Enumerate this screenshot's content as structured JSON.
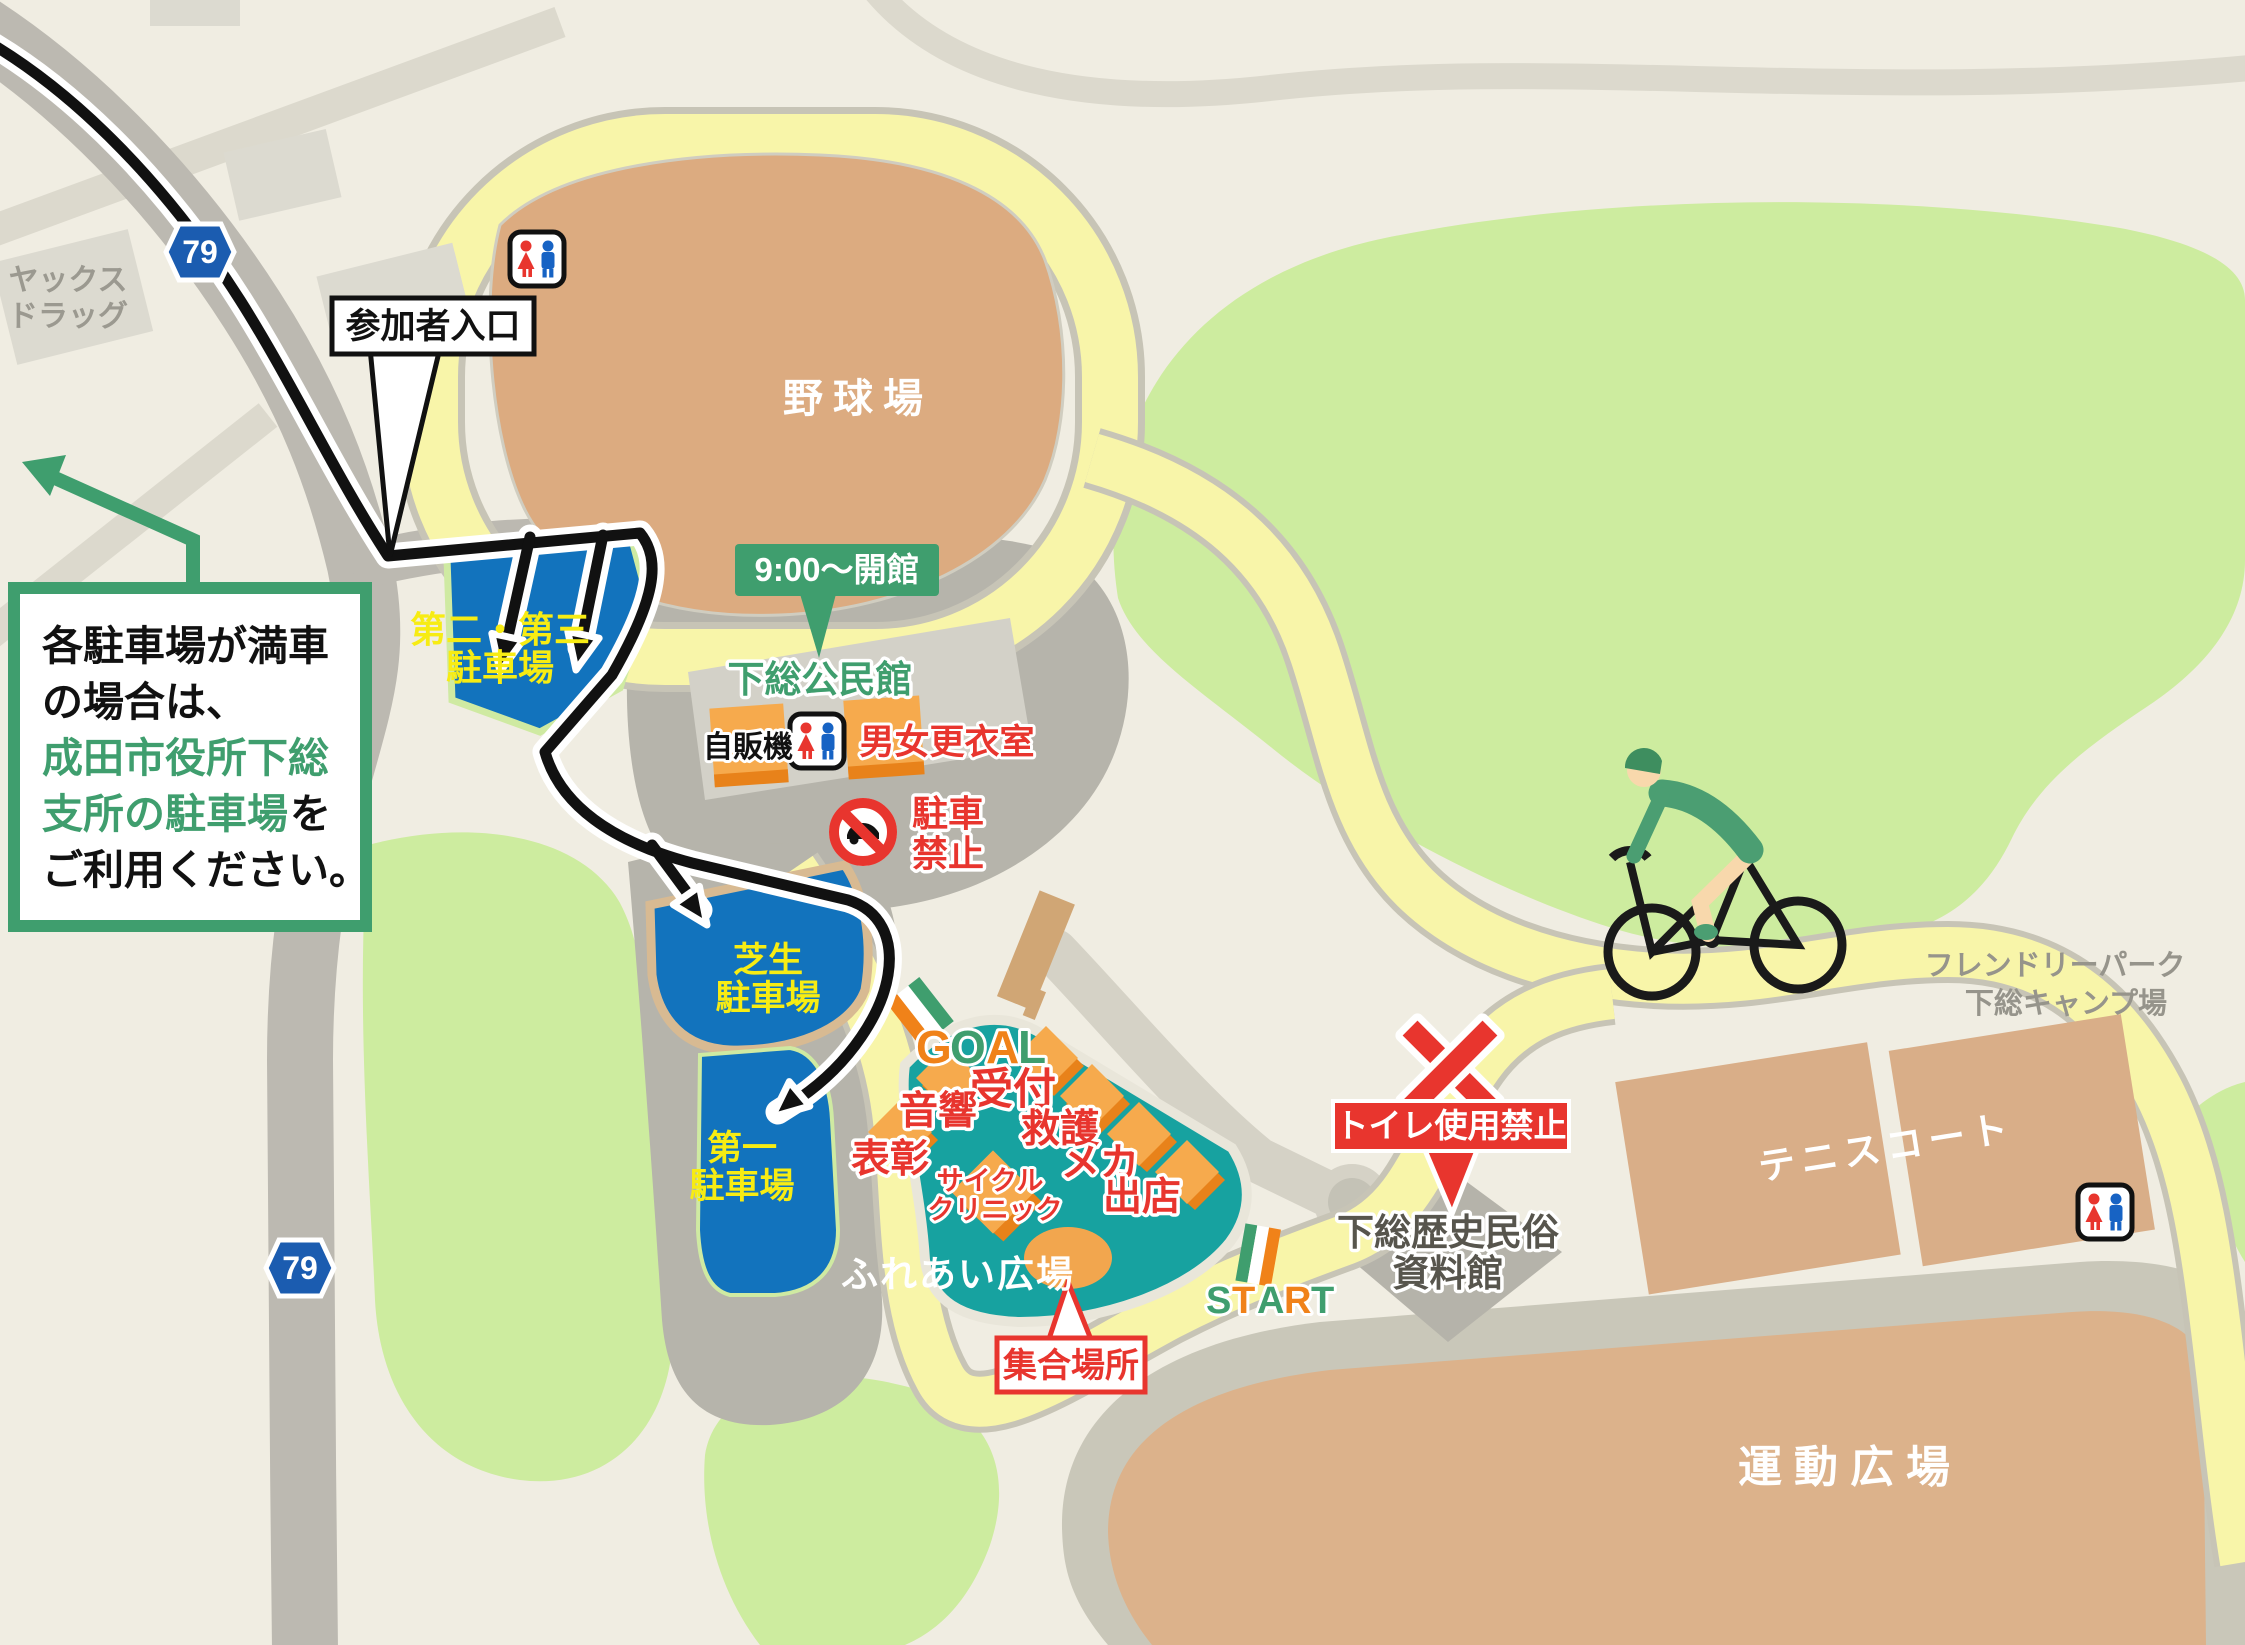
{
  "colors": {
    "background": "#f0ede2",
    "road_gray": "#bcb9b1",
    "road_light": "#dcd9cd",
    "road_yellow": "#f8f5a9",
    "green_area": "#cdec9f",
    "parking_blue": "#1273bd",
    "parking_label_yellow": "#f7ec13",
    "accent_green": "#3f9e6e",
    "alert_red": "#e8352e",
    "stand_orange": "#f6aa4d",
    "field_brown": "#dcab80",
    "plaza_teal": "#17a2a0"
  },
  "roads": {
    "route_number": "79"
  },
  "landmarks": {
    "drugstore_line1": "ヤックス",
    "drugstore_line2": "ドラッグ",
    "baseball_field": "野球場",
    "opening_hours": "9:00〜開館",
    "community_hall": "下総公民館",
    "vending_machine": "自販機",
    "changing_room": "男女更衣室",
    "museum_line1": "下総歴史民俗",
    "museum_line2": "資料館",
    "friendly_park_line1": "フレンドリーパーク",
    "friendly_park_line2": "下総キャンプ場",
    "tennis_court": "テニスコート",
    "sports_field": "運動広場",
    "plaza_name": "ふれあい広場"
  },
  "parking": {
    "entrance_label": "参加者入口",
    "lot23_line1": "第二・第三",
    "lot23_line2": "駐車場",
    "lawn_line1": "芝生",
    "lawn_line2": "駐車場",
    "lot1_line1": "第一",
    "lot1_line2": "駐車場",
    "no_parking_line1": "駐車",
    "no_parking_line2": "禁止",
    "notice_line1": "各駐車場が満車",
    "notice_line2": "の場合は、",
    "notice_line3": "成田市役所下総",
    "notice_line4_highlight": "支所の駐車場",
    "notice_line4_suffix": "を",
    "notice_line5": "ご利用ください。"
  },
  "event": {
    "goal_letters": [
      {
        "ch": "G",
        "color": "#f08219"
      },
      {
        "ch": "O",
        "color": "#3f9e6e"
      },
      {
        "ch": "A",
        "color": "#f08219"
      },
      {
        "ch": "L",
        "color": "#3f9e6e"
      }
    ],
    "start_letters": [
      {
        "ch": "S",
        "color": "#3f9e6e"
      },
      {
        "ch": "T",
        "color": "#f08219"
      },
      {
        "ch": "A",
        "color": "#3f9e6e"
      },
      {
        "ch": "R",
        "color": "#f08219"
      },
      {
        "ch": "T",
        "color": "#3f9e6e"
      }
    ],
    "reception": "受付",
    "first_aid": "救護",
    "mechanic": "メカ",
    "booths": "出店",
    "sound": "音響",
    "awards": "表彰",
    "cycle_clinic_line1": "サイクル",
    "cycle_clinic_line2": "クリニック",
    "meeting_point": "集合場所",
    "toilet_ban": "トイレ使用禁止"
  }
}
